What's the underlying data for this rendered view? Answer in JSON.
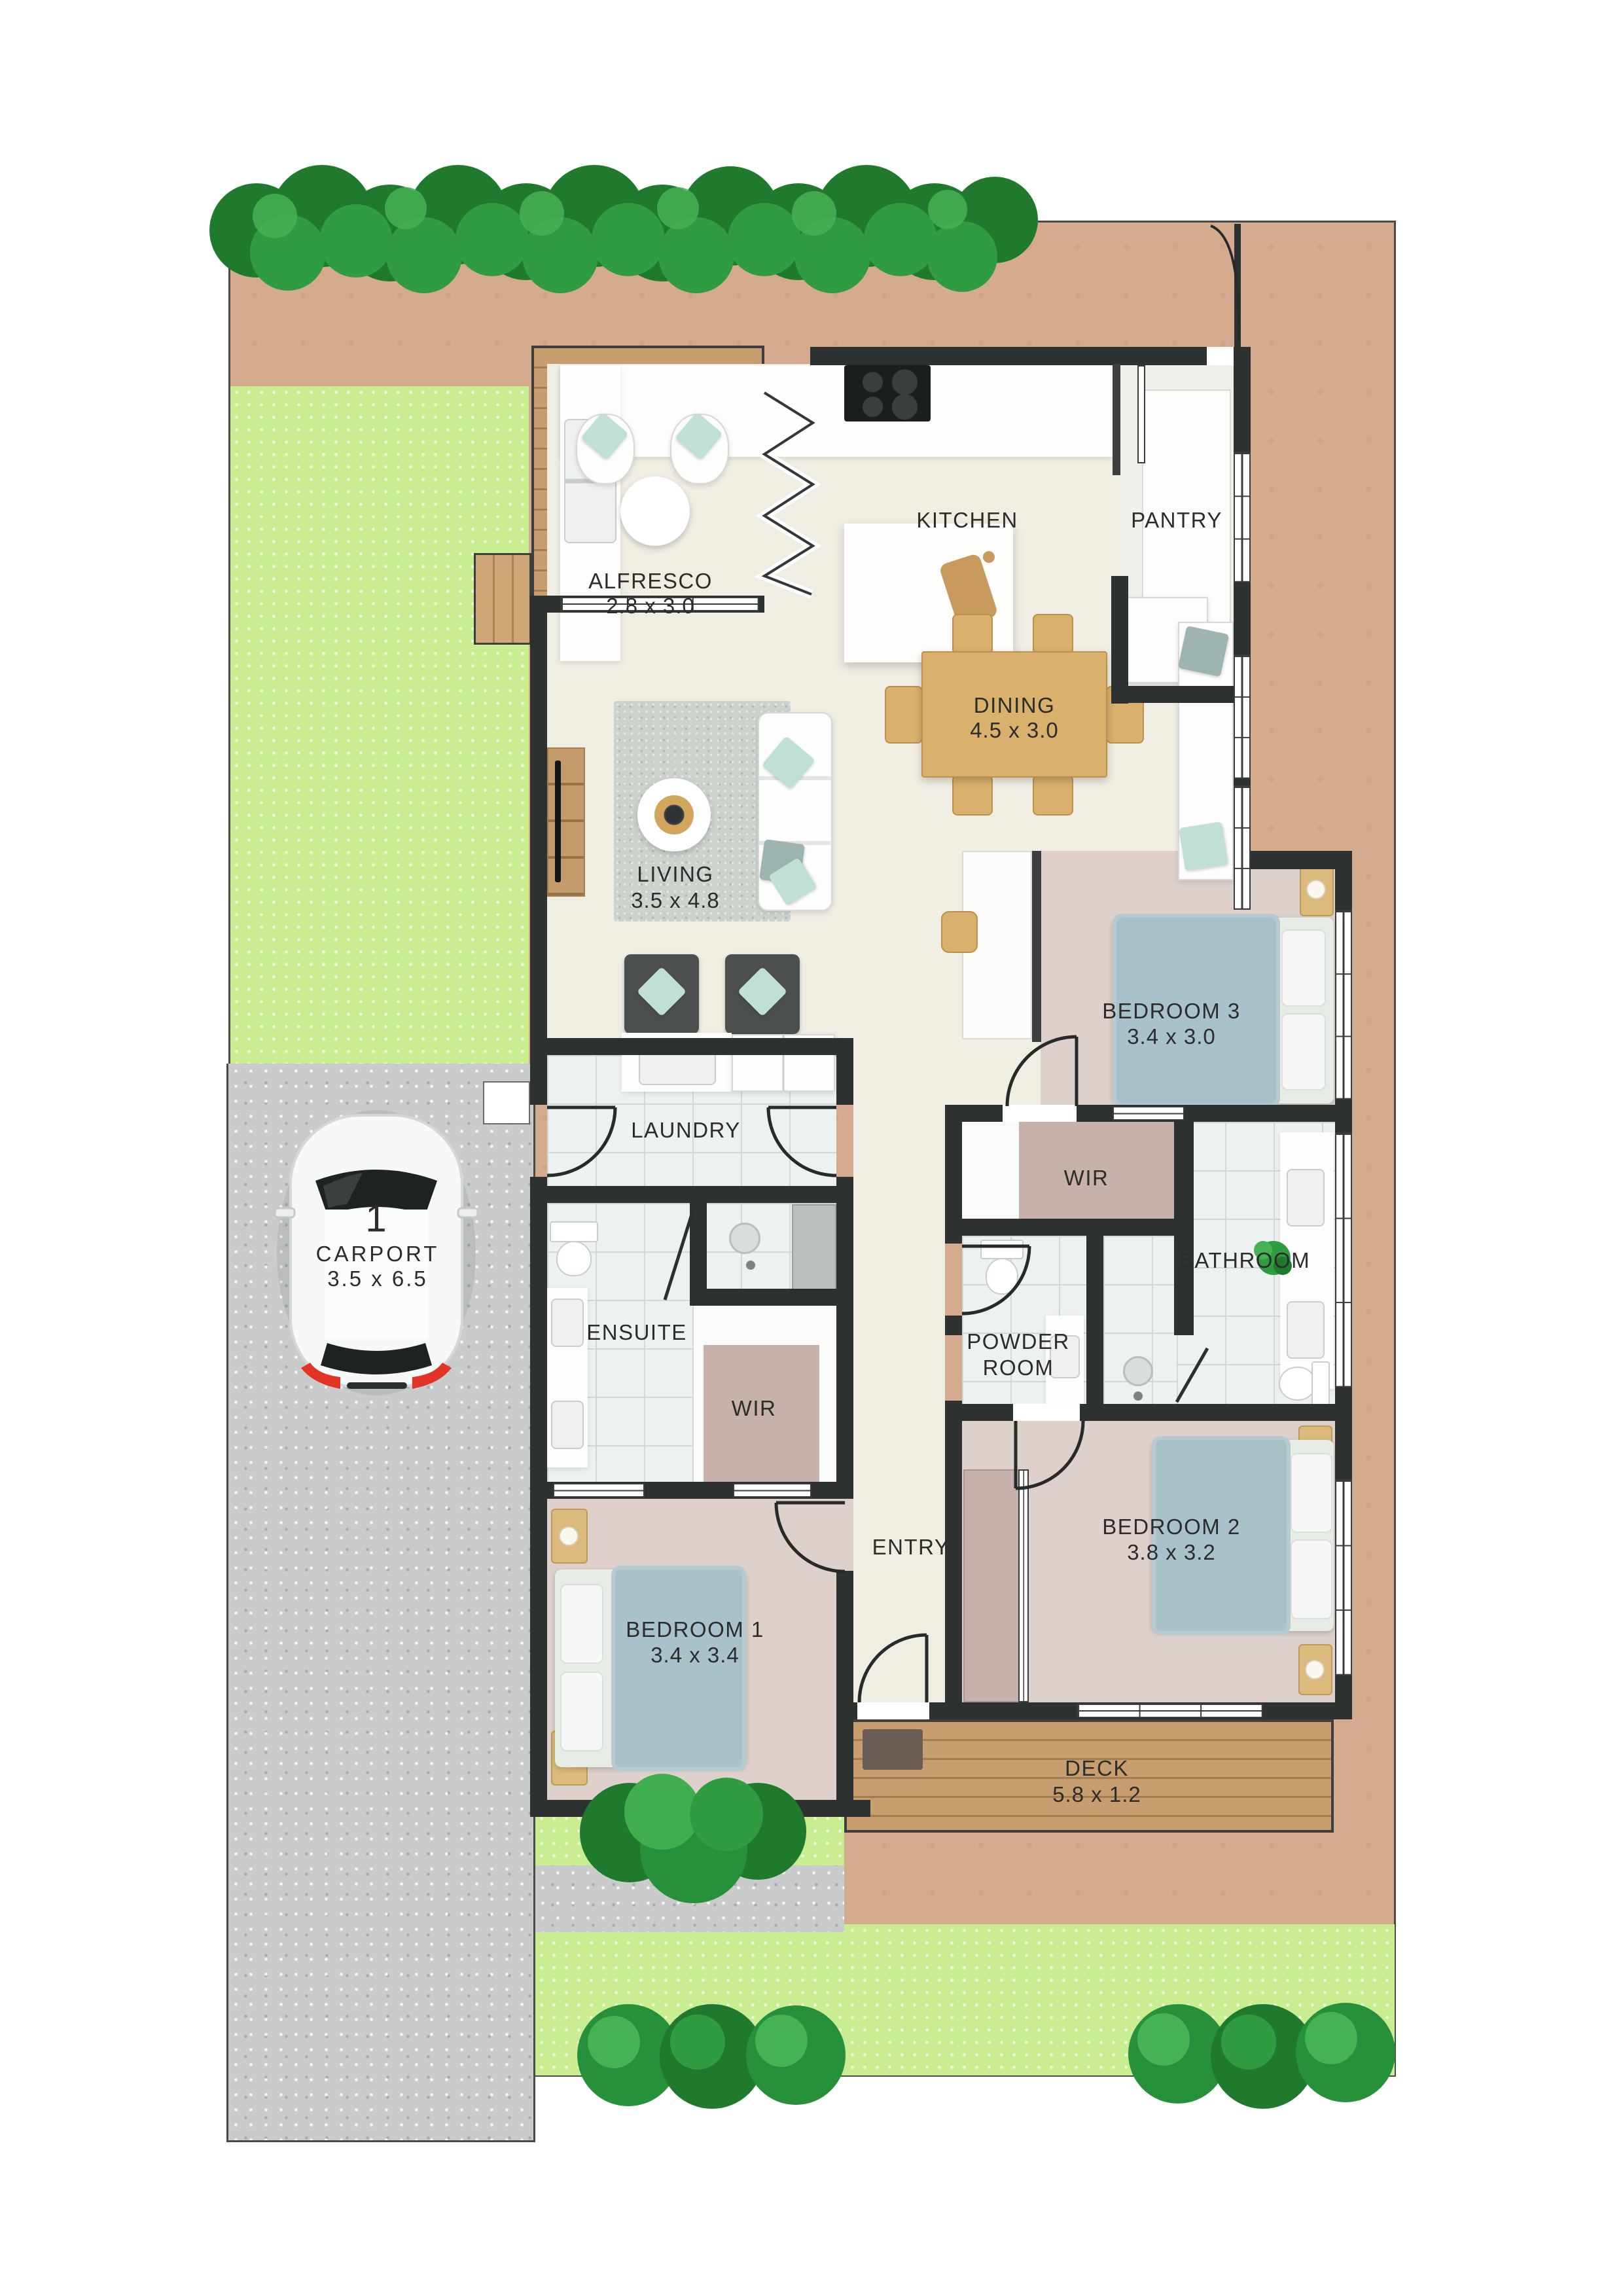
{
  "plan": {
    "type": "residential floor plan, top-down site view",
    "rooms": {
      "alfresco": {
        "label": "ALFRESCO",
        "dims": "2.8 x 3.0"
      },
      "kitchen": {
        "label": "KITCHEN"
      },
      "pantry": {
        "label": "PANTRY"
      },
      "dining": {
        "label": "DINING",
        "dims": "4.5 x 3.0"
      },
      "living": {
        "label": "LIVING",
        "dims": "3.5 x 4.8"
      },
      "bedroom3": {
        "label": "BEDROOM 3",
        "dims": "3.4 x 3.0"
      },
      "laundry": {
        "label": "LAUNDRY"
      },
      "wir_bed3": {
        "label": "WIR"
      },
      "bathroom": {
        "label": "BATHROOM"
      },
      "powder": {
        "label": "POWDER ROOM"
      },
      "ensuite": {
        "label": "ENSUITE"
      },
      "wir_bed1": {
        "label": "WIR"
      },
      "bedroom1": {
        "label": "BEDROOM 1",
        "dims": "3.4 x 3.4"
      },
      "bedroom2": {
        "label": "BEDROOM 2",
        "dims": "3.8 x 3.2"
      },
      "entry": {
        "label": "ENTRY"
      },
      "deck": {
        "label": "DECK",
        "dims": "5.8 x 1.2"
      },
      "carport": {
        "label": "CARPORT",
        "dims": "3.5 x 6.5",
        "bay": "1"
      }
    },
    "colors": {
      "wall": "#2d3130",
      "lot_ground": "#d5ab8f",
      "lawn": "#c8ee91",
      "driveway": "#cacccb",
      "timber_deck": "#c79e6f",
      "floor_living": "#f0ede3",
      "floor_bedroom": "#ded0cb",
      "floor_wet_area": "#edf1f0",
      "robe_carpet": "#c6b1ab",
      "hedge_green": "#2a9140",
      "accent_cushion": "#bfe0d2"
    }
  }
}
